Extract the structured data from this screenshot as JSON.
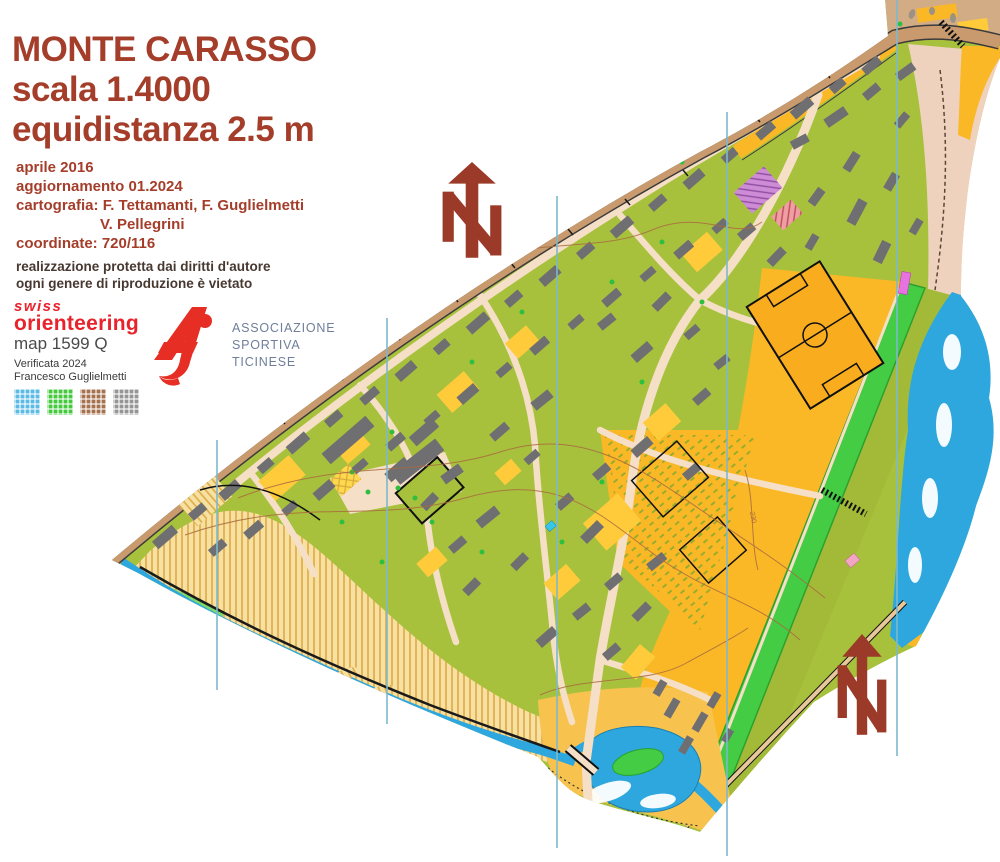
{
  "sheet": {
    "bg": "#FFFFFF"
  },
  "title_block": {
    "color": "#A43E2A",
    "line1": "MONTE CARASSO",
    "line2": "scala 1.4000",
    "line3": "equidistanza 2.5 m"
  },
  "info_block": {
    "color": "#A43E2A",
    "line1": "aprile 2016",
    "line2": "aggiornamento 01.2024",
    "line3": "cartografia: F. Tettamanti, F. Guglielmetti",
    "line4": "V. Pellegrini",
    "line5": "coordinate: 720/116"
  },
  "copyright_block": {
    "color": "#473830",
    "line1": "realizzazione protetta dai diritti d'autore",
    "line2": "ogni genere di riproduzione è vietato"
  },
  "swiss_logo": {
    "brand_color": "#E8232B",
    "brand_top": "swiss",
    "brand_main": "orienteering",
    "map_ref": "map 1599 Q",
    "verified": "Verificata 2024",
    "verifier": "Francesco Guglielmetti",
    "print_check_colors": [
      "#5BBBE4",
      "#45C93D",
      "#A6714E",
      "#969696"
    ]
  },
  "asti_logo": {
    "glyph": "asti-monogram",
    "glyph_color": "#E62E24",
    "text_color": "#6F7E99",
    "line1": "ASSOCIAZIONE",
    "line2": "SPORTIVA",
    "line3": "TICINESE"
  },
  "north_arrows": {
    "icon": "north-arrow-icon",
    "color": "#9B3A28",
    "count": 2
  },
  "map": {
    "type": "sprint-orienteering-map",
    "contour_label": "230",
    "palette": {
      "olive": "#A8C13D",
      "orange_open": "#FBB826",
      "yellow_open": "#FFCB3B",
      "building_gray": "#6F6F71",
      "road_cream": "#F5DFC6",
      "road_tan": "#C89A6E",
      "water_blue": "#2EA7DF",
      "vegetation_green": "#44CC44",
      "floodplain_stripe": "#DFAA45",
      "pale_pink": "#EFD2BE",
      "contour_brown": "#A96B3F",
      "magnetic_line_blue": "#7CB9CF"
    }
  }
}
